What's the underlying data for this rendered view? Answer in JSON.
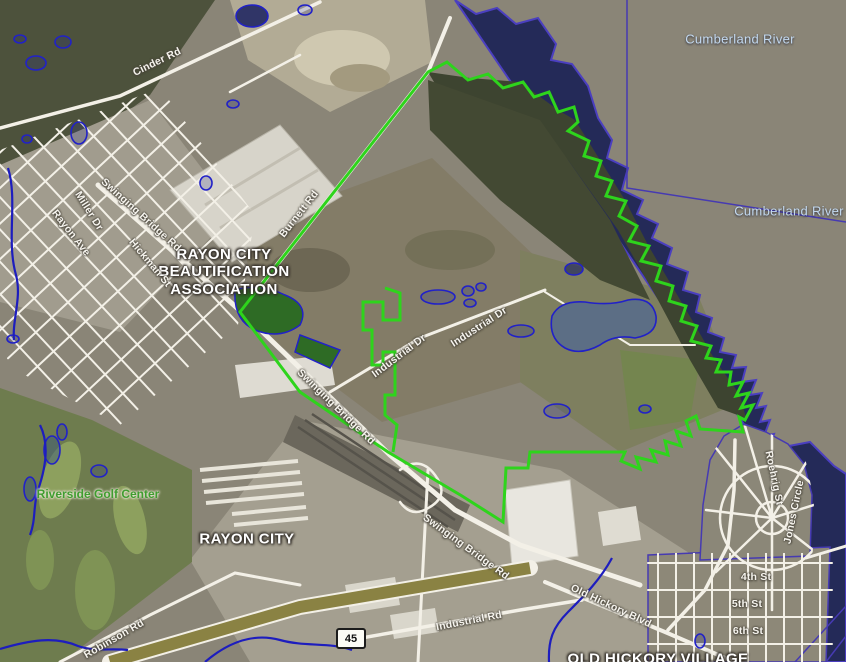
{
  "map": {
    "colors": {
      "water_fill": "#242a58",
      "water_outline": "#4b3fc0",
      "site_boundary_green": "#2ed41c",
      "wetland_outline_blue": "#2121c8",
      "stream_blue": "#1d1dbe",
      "road_white": "#f3f0e7",
      "highway_olive": "#8a8243"
    },
    "shield": {
      "route": "45"
    },
    "labels": {
      "water": [
        {
          "text": "Cumberland River",
          "x": 740,
          "y": 39
        },
        {
          "text": "Cumberland River",
          "x": 789,
          "y": 211
        }
      ],
      "places": [
        {
          "text": "RAYON CITY BEAUTIFICATION ASSOCIATION",
          "x": 224,
          "y": 272,
          "w": 145
        },
        {
          "text": "RAYON CITY",
          "x": 247,
          "y": 539
        },
        {
          "text": "OLD HICKORY VILLAGE",
          "x": 658,
          "y": 659
        }
      ],
      "golf": [
        {
          "text": "Riverside Golf Center",
          "x": 98,
          "y": 494
        }
      ],
      "roads": [
        {
          "text": "Cinder Rd",
          "x": 157,
          "y": 62,
          "r": -26
        },
        {
          "text": "Burnett Rd",
          "x": 299,
          "y": 214,
          "r": -52
        },
        {
          "text": "Swinging Bridge Rd",
          "x": 141,
          "y": 215,
          "r": 42
        },
        {
          "text": "Rayon Ave",
          "x": 71,
          "y": 233,
          "r": 52
        },
        {
          "text": "Miller Dr",
          "x": 89,
          "y": 211,
          "r": 58
        },
        {
          "text": "Hickman St",
          "x": 150,
          "y": 263,
          "r": 50
        },
        {
          "text": "Industrial Dr",
          "x": 399,
          "y": 356,
          "r": -37
        },
        {
          "text": "Industrial Dr",
          "x": 479,
          "y": 327,
          "r": -33
        },
        {
          "text": "Swinging Bridge Rd",
          "x": 336,
          "y": 407,
          "r": 44
        },
        {
          "text": "Swinging Bridge Rd",
          "x": 466,
          "y": 547,
          "r": 36
        },
        {
          "text": "Old Hickory Blvd",
          "x": 611,
          "y": 606,
          "r": 25
        },
        {
          "text": "Industrial Rd",
          "x": 469,
          "y": 621,
          "r": -11
        },
        {
          "text": "Robinson Rd",
          "x": 114,
          "y": 639,
          "r": -30
        },
        {
          "text": "Roehrig St",
          "x": 774,
          "y": 478,
          "r": 78
        },
        {
          "text": "Jones Circle",
          "x": 794,
          "y": 512,
          "r": -78
        },
        {
          "text": "4th St",
          "x": 756,
          "y": 577,
          "r": 0
        },
        {
          "text": "5th St",
          "x": 747,
          "y": 604,
          "r": 0
        },
        {
          "text": "6th St",
          "x": 748,
          "y": 631,
          "r": 0
        }
      ]
    }
  }
}
